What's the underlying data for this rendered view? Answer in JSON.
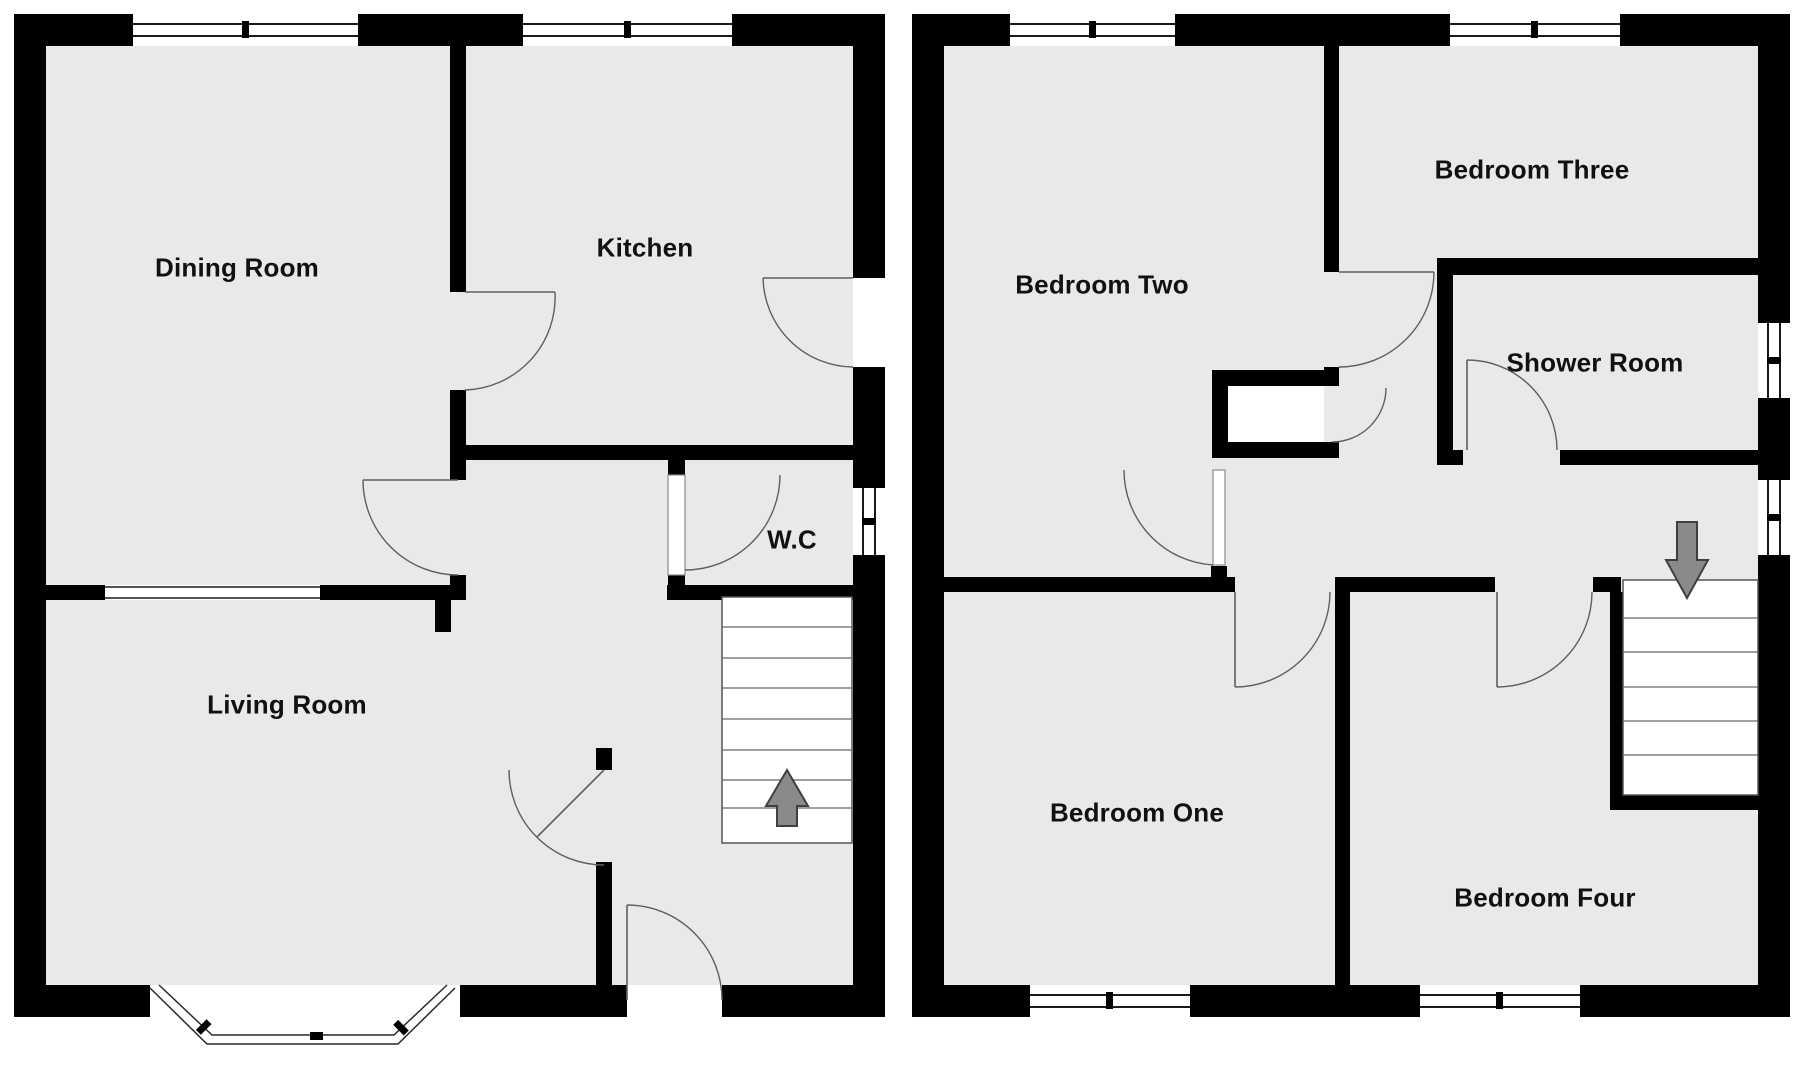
{
  "document": {
    "type": "floor-plan",
    "plan_count": 2
  },
  "floor_plans": {
    "left": {
      "rooms": {
        "dining_room": "Dining Room",
        "kitchen": "Kitchen",
        "wc": "W.C",
        "living_room": "Living Room"
      },
      "features": {
        "stairs_arrow": "up-arrow-icon",
        "bay_window": "bay-window",
        "front_door": "front-door"
      }
    },
    "right": {
      "rooms": {
        "bedroom_two": "Bedroom Two",
        "bedroom_three": "Bedroom Three",
        "shower_room": "Shower Room",
        "bedroom_one": "Bedroom One",
        "bedroom_four": "Bedroom Four"
      },
      "features": {
        "stairs_arrow": "down-arrow-icon"
      }
    }
  },
  "colors": {
    "wall": "#000000",
    "floor": "#e9e9e9",
    "background": "#ffffff",
    "stair_arrow": "#8a8a8a",
    "label": "#111111"
  }
}
